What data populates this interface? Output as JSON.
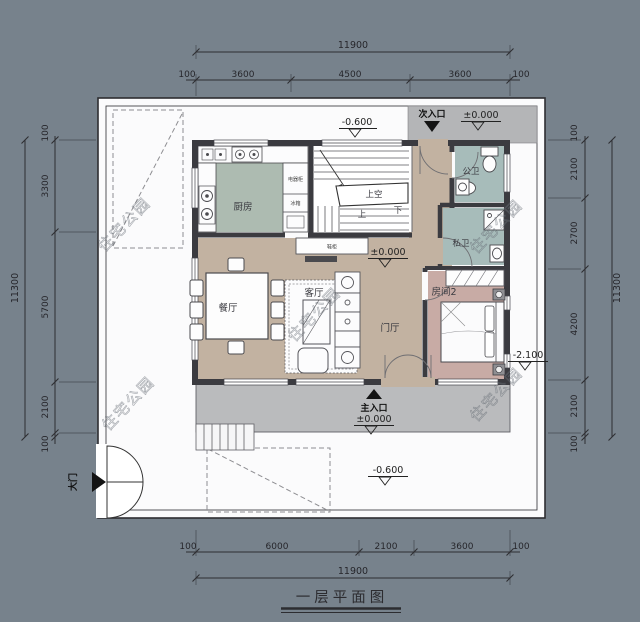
{
  "title": {
    "text": "一层平面图"
  },
  "watermark": {
    "text": "住宅公园"
  },
  "dimensions": {
    "top": {
      "overall": "11900",
      "segments": [
        "100",
        "3600",
        "4500",
        "3600",
        "100"
      ]
    },
    "bottom": {
      "overall": "11900",
      "segments": [
        "100",
        "6000",
        "2100",
        "3600",
        "100"
      ]
    },
    "left": {
      "overall": "11300",
      "segments": [
        "100",
        "3300",
        "5700",
        "2100",
        "100"
      ]
    },
    "right": {
      "overall": "11300",
      "segments": [
        "100",
        "2100",
        "2700",
        "4200",
        "2100",
        "100"
      ]
    }
  },
  "rooms": {
    "kitchen": "厨房",
    "dining": "餐厅",
    "living": "客厅",
    "foyer": "门厅",
    "shared_bath": "公卫",
    "private_bath": "私卫",
    "bedroom2": "房间2",
    "stair_void": "上空",
    "stair_up": "上",
    "stair_down": "下"
  },
  "cabinets": {
    "appliance": "电器柜",
    "fridge": "冰箱",
    "understair": "鞋柜"
  },
  "entrances": {
    "main": "主入口",
    "secondary": "次入口",
    "gate": "大门"
  },
  "levels": {
    "zero": "±0.000",
    "minus_0_6": "-0.600",
    "minus_2_1": "-2.100"
  },
  "icons": {
    "level_triangle": "open-down-triangle",
    "arrow_up": "solid-up-triangle",
    "arrow_down": "solid-down-triangle",
    "arrow_right": "solid-right-triangle"
  },
  "colors": {
    "background": "#77828c",
    "courtyard": "#fbfbfc",
    "wall": "#3b3b40",
    "floor_main": "#c2b2a1",
    "floor_kitchen": "#adbbb1",
    "floor_bath": "#a7bcba",
    "floor_bedroom": "#c8aba5",
    "porch": "#b4b5b7",
    "terrace": "#babbbd"
  }
}
